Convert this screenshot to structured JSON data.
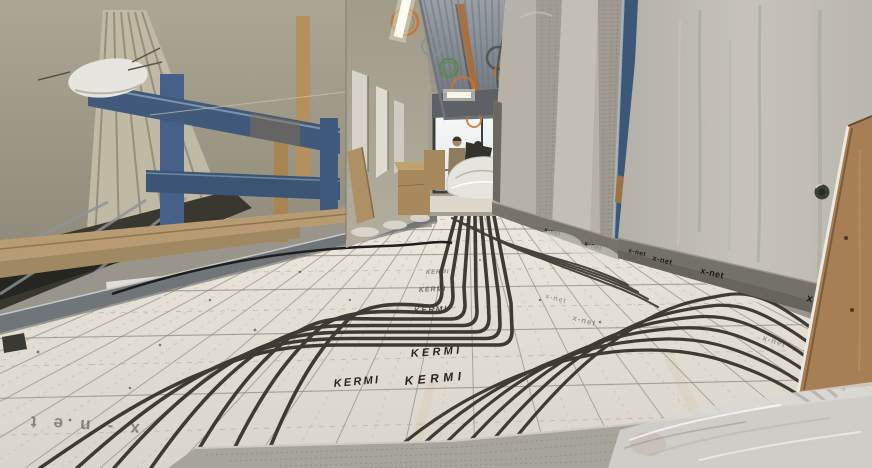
{
  "scene": {
    "description": "Construction-site corridor with underfloor heating being installed: dark heating pipes laid in sweeping curves over white tacker insulation panels printed with a measuring grid, blue wooden guard rails at left, raw concrete walls and pillar at right, two workers talking at the bright window at the corridor end.",
    "branding": {
      "panel_logo": "KERMI",
      "system_label": "x-net"
    },
    "colors": {
      "floor_panel": "#e2ded4",
      "grid_line": "#8b8779",
      "heating_pipe": "#3d3b34",
      "edge_insulation_strip": "#747168",
      "guard_rail_blue": "#41597a",
      "concrete": "#bcb9b1",
      "chipboard_brown": "#a87f55",
      "safety_orange": "#c4732f",
      "window_light": "#f2f4f2"
    }
  }
}
